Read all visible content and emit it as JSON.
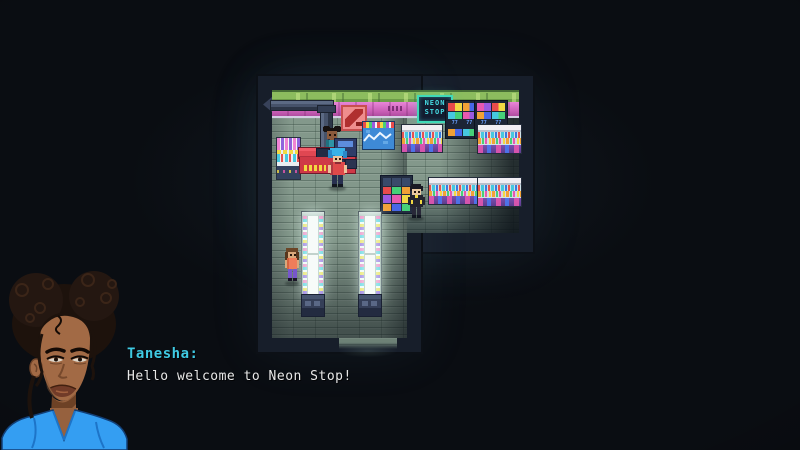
{
  "store_sign": {
    "line1": "NEON",
    "line2": "STOP"
  },
  "racks": {
    "price_tag": "77"
  },
  "dialogue": {
    "speaker": "Tanesha:",
    "line": "Hello welcome to Neon Stop!"
  },
  "portrait": {
    "character": "Tanesha"
  },
  "npcs": [
    {
      "name": "cashier"
    },
    {
      "name": "blue-haired customer"
    },
    {
      "name": "shopper in black-yellow jacket"
    },
    {
      "name": "shopper with brown hair"
    }
  ],
  "palette": {
    "background": "#0a0d12",
    "speaker_name": "#3fc9e2",
    "dialogue_text": "#e8e8e8",
    "sign_text": "#46dbe4",
    "wall_green": "#8cbc5e",
    "wall_pink": "#c75cb4",
    "floor": "#83988b",
    "counter_red": "#e04752"
  }
}
